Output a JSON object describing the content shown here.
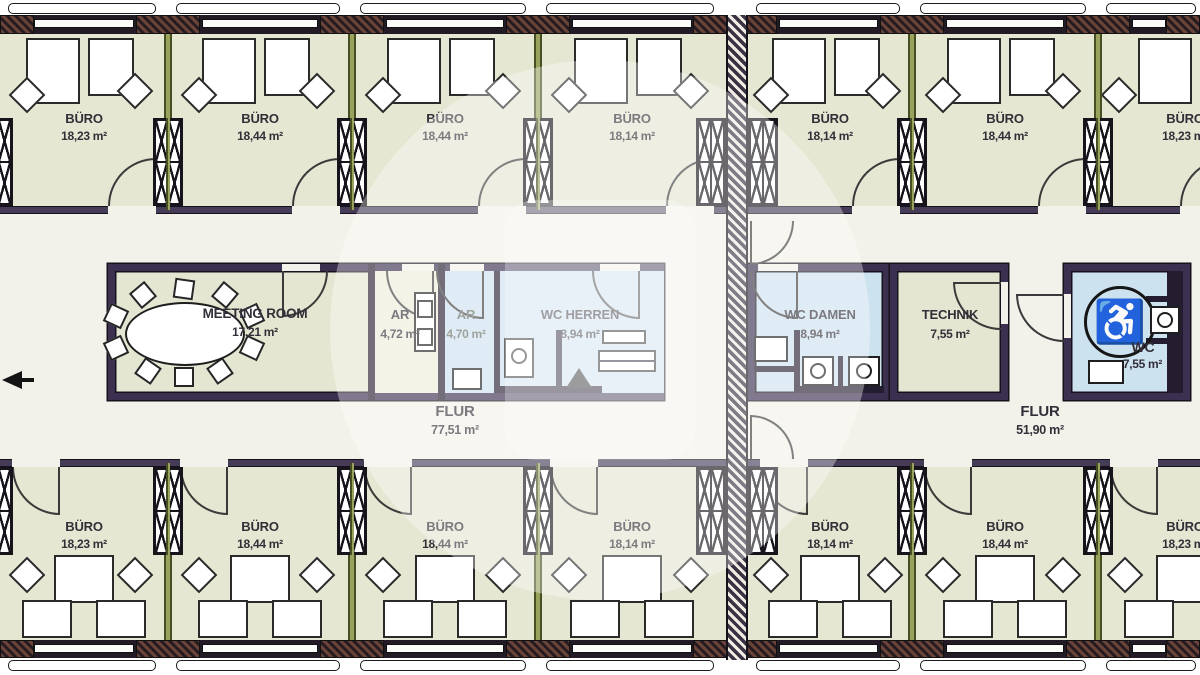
{
  "colors": {
    "office_floor": "#e5e7d2",
    "corridor_floor": "#f2f1ea",
    "wet_room_floor": "#cde2ef",
    "storage_floor": "#eceddc",
    "wall_dark": "#3b3050",
    "exterior_wall": "#221a24",
    "partition_olive": "#6d7a35",
    "pier_brown": "#6a4338",
    "label_text": "#332f38"
  },
  "offices_top": [
    {
      "name": "BÜRO",
      "area": "18,23 m²"
    },
    {
      "name": "BÜRO",
      "area": "18,44 m²"
    },
    {
      "name": "BÜRO",
      "area": "18,44 m²"
    },
    {
      "name": "BÜRO",
      "area": "18,14 m²"
    },
    {
      "name": "BÜRO",
      "area": "18,14 m²"
    },
    {
      "name": "BÜRO",
      "area": "18,44 m²"
    },
    {
      "name": "BÜRO",
      "area": "18,23 m²"
    }
  ],
  "offices_bottom": [
    {
      "name": "BÜRO",
      "area": "18,23 m²"
    },
    {
      "name": "BÜRO",
      "area": "18,44 m²"
    },
    {
      "name": "BÜRO",
      "area": "18,44 m²"
    },
    {
      "name": "BÜRO",
      "area": "18,14 m²"
    },
    {
      "name": "BÜRO",
      "area": "18,14 m²"
    },
    {
      "name": "BÜRO",
      "area": "18,44 m²"
    },
    {
      "name": "BÜRO",
      "area": "18,23 m²"
    }
  ],
  "rooms": {
    "meeting": {
      "name": "MEETING ROOM",
      "area": "17,21 m²"
    },
    "ar1": {
      "name": "AR",
      "area": "4,72 m²"
    },
    "ar2": {
      "name": "AR",
      "area": "4,70 m²"
    },
    "wc_herren": {
      "name": "WC HERREN",
      "area": "8,94 m²"
    },
    "wc_damen": {
      "name": "WC DAMEN",
      "area": "8,94 m²"
    },
    "technik": {
      "name": "TECHNIK",
      "area": "7,55 m²"
    },
    "wc_barrierefrei": {
      "name": "WC",
      "area": "7,55 m²"
    }
  },
  "corridors": {
    "flur_west": {
      "name": "FLUR",
      "area": "77,51 m²"
    },
    "flur_ost": {
      "name": "FLUR",
      "area": "51,90 m²"
    }
  },
  "icons": {
    "wheelchair": "♿"
  }
}
